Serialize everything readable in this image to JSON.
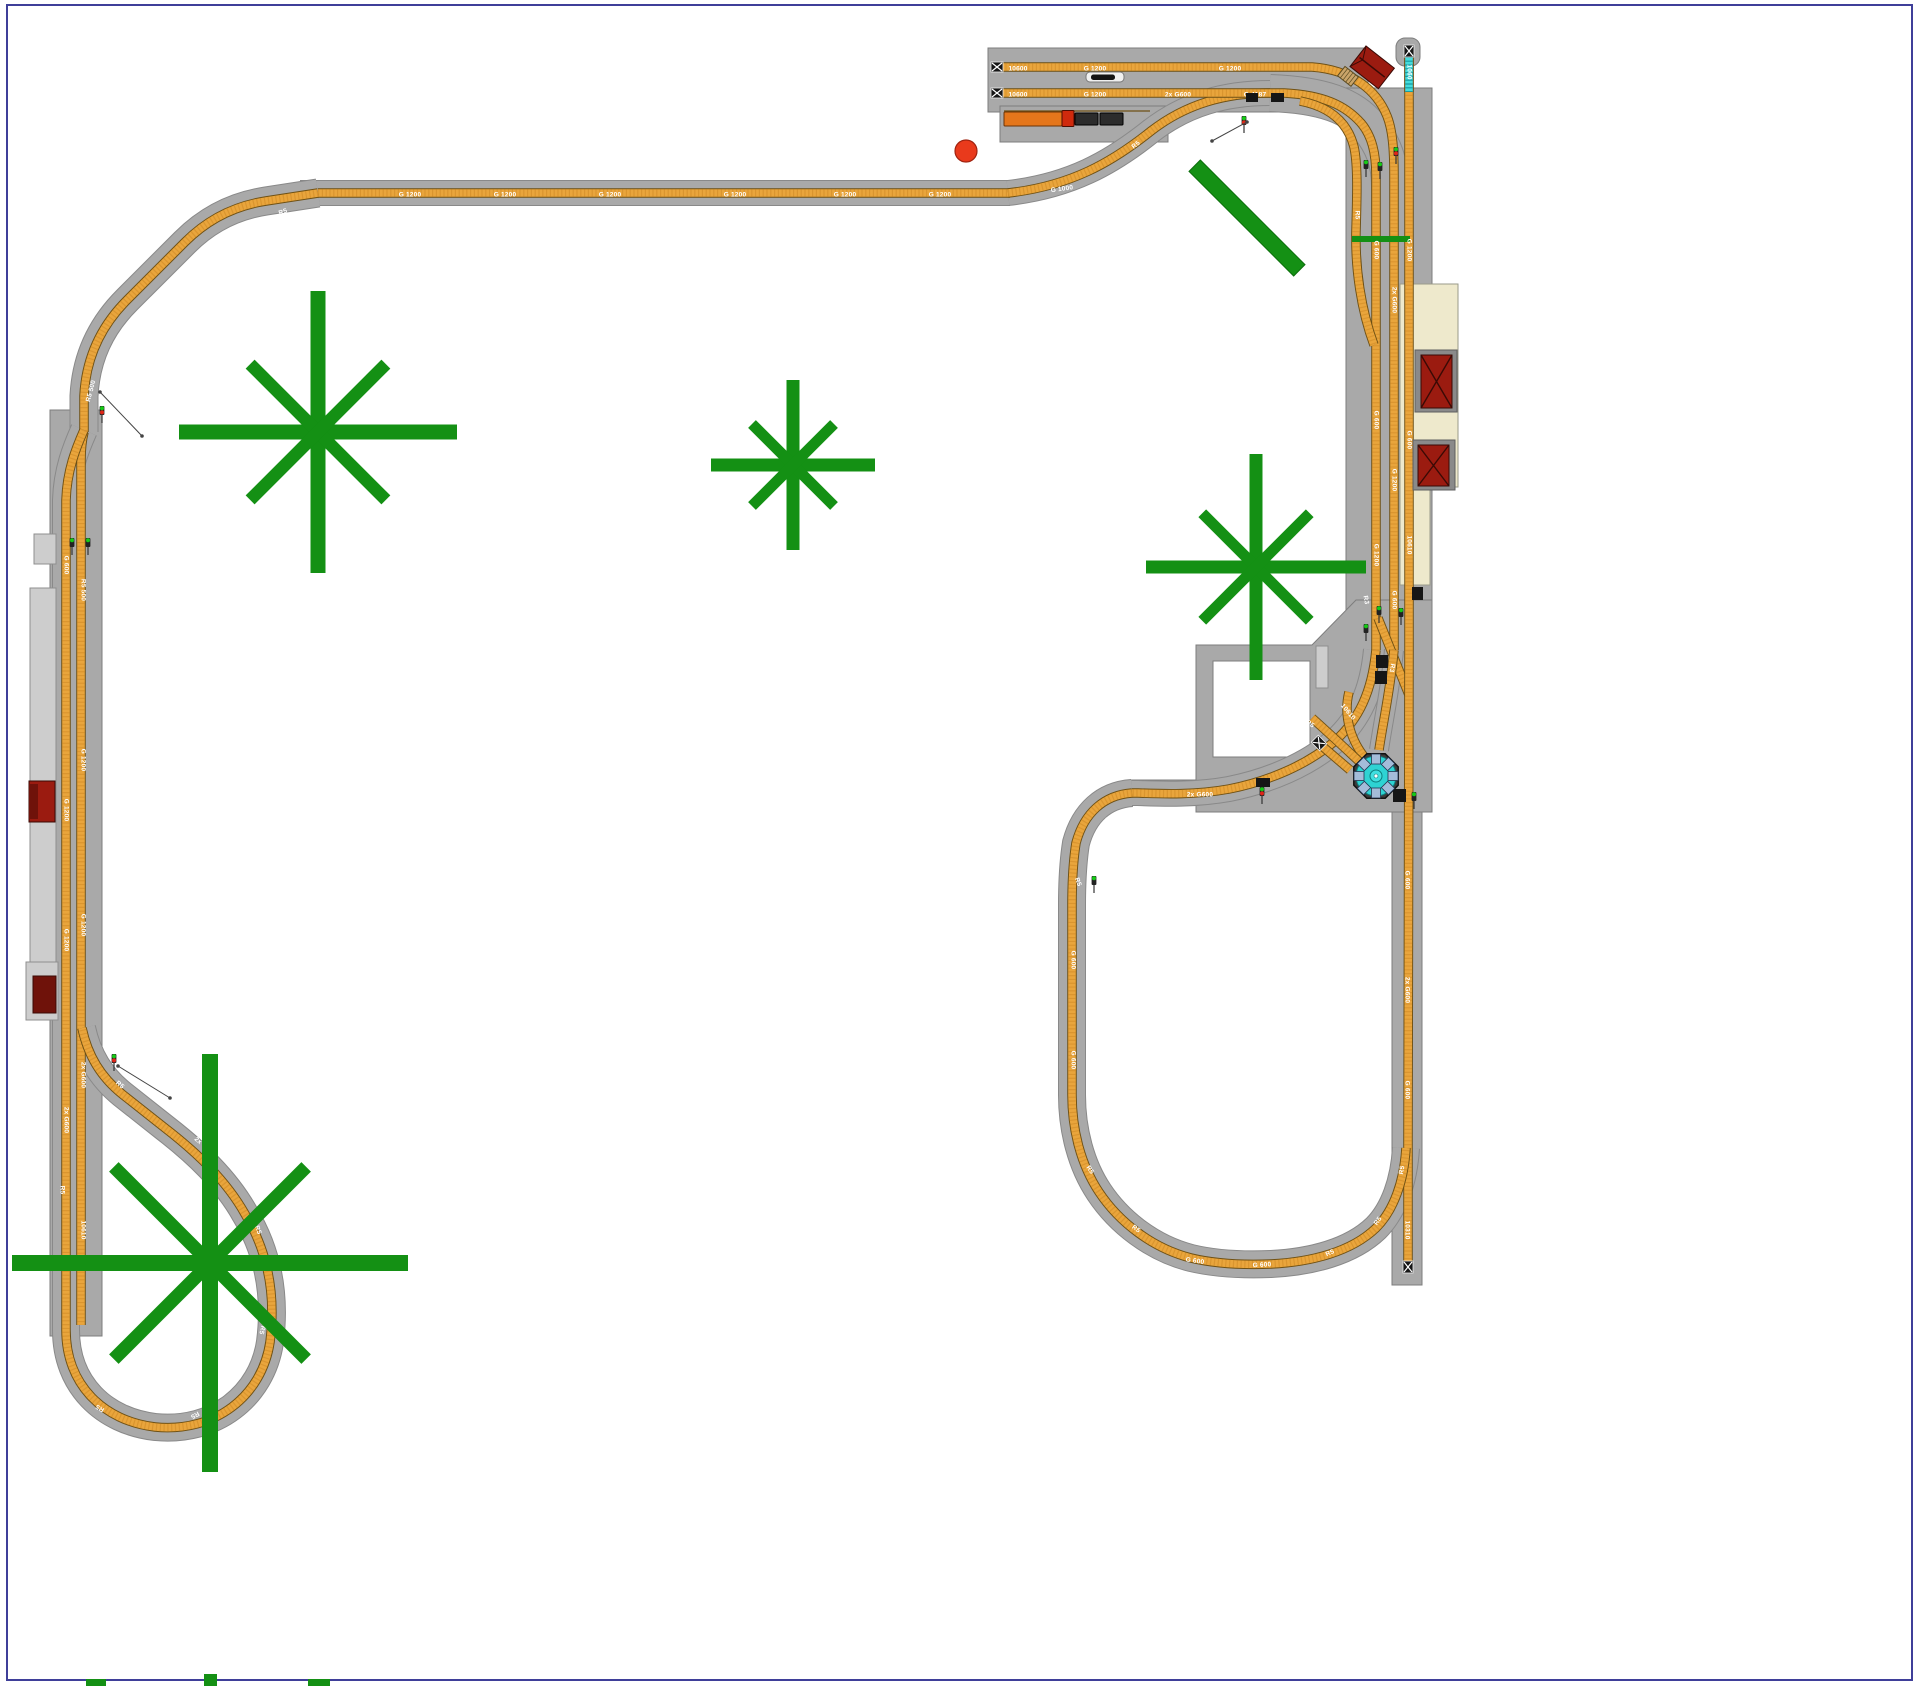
{
  "title": "G-scale model railway track plan",
  "colors": {
    "bg": "#ffffff",
    "border": "#3f3f99",
    "roadbed": "#a9a9a9",
    "roadbed_edge": "#898989",
    "gray_fill": "#a9a9a9",
    "gray_edge": "#7d7d7d",
    "platform": "#cdcdcd",
    "platform_edge": "#8f8f8f",
    "cream": "#eee9cc",
    "cream_edge": "#9a9a8a",
    "track_edge": "#6e5014",
    "track_fill": "#e9a53c",
    "track_tie": "#c8832176",
    "cyan_track": "#43dcdc",
    "building_red": "#9b1b10",
    "building_dark": "#6f120a",
    "roof_line": "#3a0a05",
    "tree": "#149014",
    "tree_edge": "#0c6e0c",
    "turntable_cyan": "#2ed3d3",
    "turntable_stub": "#a4bcd9",
    "signal_green": "#16c916",
    "signal_red": "#e02618",
    "black": "#161616",
    "dot_red": "#e93a1c",
    "dot_red_edge": "#a02310",
    "white": "#ffffff"
  },
  "grays": [
    {
      "r": [
        988,
        48,
        380,
        64
      ],
      "name": "siding-yard-base"
    },
    {
      "r": [
        1000,
        106,
        168,
        36
      ],
      "name": "siding-yard-base-lower"
    },
    {
      "r": [
        1346,
        88,
        86,
        567
      ],
      "name": "right-main-roadbed-strip"
    },
    {
      "r": [
        1130,
        780,
        70,
        24
      ],
      "name": "oval-top-roadbed-strip"
    },
    {
      "r": [
        1392,
        812,
        30,
        473
      ],
      "name": "right-siding-roadbed-strip"
    },
    {
      "r": [
        50,
        410,
        52,
        926
      ],
      "name": "left-main-roadbed-strip"
    },
    {
      "r": [
        1396,
        38,
        24,
        28,
        9
      ],
      "name": "top-right-buffer-cap"
    }
  ],
  "gray_paths": [
    {
      "d": "M1196,645 L1312,645 L1356,600 L1432,600 L1432,812 L1196,812 Z M1213,661 L1310,661 L1310,757 L1213,757 Z",
      "name": "engine-shed-footprint"
    }
  ],
  "platforms": [
    {
      "r": [
        30,
        588,
        26,
        374
      ],
      "name": "left-platform"
    },
    {
      "r": [
        34,
        534,
        22,
        30
      ],
      "name": "left-platform-tab"
    },
    {
      "r": [
        26,
        962,
        32,
        58
      ],
      "name": "left-platform-lower"
    },
    {
      "r": [
        1316,
        646,
        12,
        42
      ],
      "name": "mid-right-platform"
    }
  ],
  "cream_path": {
    "d": "M1400,284 L1458,284 L1458,487 L1430,487 L1430,585 L1400,585 Z",
    "name": "station-platform-cream"
  },
  "roadbeds": [
    {
      "d": "M300,193 L1010,193",
      "w": 24
    },
    {
      "d": "M318,193 L266,201 C233,206 207,220 185,242 L127,300 C101,326 86,357 84,396 L84,432",
      "w": 27
    },
    {
      "d": "M1008,193 C1070,186 1111,163 1151,131 C1186,104 1225,93 1270,93",
      "w": 24
    },
    {
      "d": "M1270,93 C1323,95 1352,106 1369,127 C1383,144 1390,162 1390,186 L1390,210",
      "w": 36
    },
    {
      "d": "M84,430 C76,448 67,470 66,500 L66,1330 C66,1385 104,1421 155,1427 C215,1433 262,1396 270,1342 C276,1295 268,1252 245,1214 C226,1180 196,1152 165,1128 L122,1094 C101,1077 88,1056 82,1028",
      "w": 26
    },
    {
      "d": "M1132,793 C1104,795 1084,813 1076,843 C1073,862 1072,884 1072,905 L1072,1095 C1072,1130 1081,1165 1099,1192 C1119,1222 1152,1248 1191,1258 C1216,1264 1246,1265 1271,1264 C1311,1262 1351,1252 1376,1228 C1394,1210 1404,1181 1406,1148",
      "w": 26
    },
    {
      "d": "M1376,650 C1372,692 1359,719 1335,741 C1307,765 1269,781 1229,789 C1196,795 1164,794 1138,793 L1132,793",
      "w": 24
    },
    {
      "d": "M1394,650 C1390,692 1383,722 1379,750",
      "w": 18
    }
  ],
  "tracks": [
    {
      "d": "M318,193 L1010,193",
      "name": "main-line-top-straight"
    },
    {
      "d": "M318,193 L266,201 C233,206 207,220 185,242 L127,300 C101,326 86,357 84,396 L84,432",
      "name": "main-line-top-left-diagonal"
    },
    {
      "d": "M84,432 C82,440 81,450 81,460 L81,1325",
      "name": "left-inner-track"
    },
    {
      "d": "M84,430 C76,448 67,470 66,500 L66,1330 C66,1385 104,1421 155,1427 C215,1433 262,1396 270,1342 C276,1295 268,1252 245,1214 C226,1180 196,1152 165,1128 L122,1094 C101,1077 88,1056 82,1028",
      "name": "left-outer-track-balloon-loop"
    },
    {
      "d": "M1008,193 C1070,186 1111,163 1151,131 C1186,104 1225,93 1270,93",
      "name": "main-line-yard-approach"
    },
    {
      "d": "M994,67 L1312,67 C1353,70 1377,91 1387,116 C1393,131 1394,152 1394,176 L1394,650",
      "name": "yard-siding-1"
    },
    {
      "d": "M994,93 L1284,93 C1323,95 1345,105 1361,123 C1372,136 1376,153 1376,176 L1376,650",
      "name": "yard-siding-2"
    },
    {
      "d": "M1300,101 C1331,107 1348,123 1354,147 C1358,165 1357,196 1356,230 C1355,268 1361,310 1374,345",
      "name": "yard-connector-track"
    },
    {
      "d": "M1409,53 L1409,650",
      "name": "right-stub-track"
    },
    {
      "d": "M1378,618 L1409,695",
      "name": "junction-crossover"
    },
    {
      "d": "M1376,650 C1372,692 1359,719 1335,741 C1307,765 1269,781 1229,789 C1196,795 1164,794 1138,793 L1132,793",
      "name": "junction-to-oval-curve"
    },
    {
      "d": "M1394,650 C1390,692 1383,722 1379,750",
      "name": "junction-to-turntable"
    },
    {
      "d": "M1409,650 L1408,1140 L1408,1262",
      "name": "right-long-siding"
    },
    {
      "d": "M1132,793 C1104,795 1084,813 1076,843 C1073,862 1072,884 1072,905 L1072,1095 C1072,1130 1081,1165 1099,1192 C1119,1222 1152,1248 1191,1258 C1216,1264 1246,1265 1271,1264 C1311,1262 1351,1252 1376,1228 C1394,1210 1404,1181 1406,1148",
      "name": "lower-oval-track"
    },
    {
      "d": "M1349,692 C1343,716 1351,741 1366,759",
      "name": "turntable-approach-1"
    },
    {
      "d": "M1312,718 C1331,735 1349,752 1363,765",
      "name": "turntable-approach-2"
    },
    {
      "d": "M1322,746 L1350,770",
      "name": "turntable-stub-siding"
    }
  ],
  "cyan_tracks": [
    {
      "d": "M1409,53 L1409,92",
      "name": "selected-track-piece"
    }
  ],
  "misc_rects": [
    {
      "r": [
        1352,
        236,
        58,
        6
      ],
      "f": "tree",
      "name": "track-contact-strip"
    }
  ],
  "misc_lines": [
    {
      "p": [
        1004,
        111,
        1150,
        111
      ],
      "s": "#6e5014",
      "w": 1.2,
      "name": "platform-edge-rail"
    }
  ],
  "labels": [
    {
      "t": "10600",
      "x": 1018,
      "y": 69,
      "r": 0
    },
    {
      "t": "G 1200",
      "x": 1095,
      "y": 69,
      "r": 0
    },
    {
      "t": "G 1200",
      "x": 1230,
      "y": 69,
      "r": 0
    },
    {
      "t": "10600",
      "x": 1018,
      "y": 95,
      "r": 0
    },
    {
      "t": "G 1200",
      "x": 1095,
      "y": 95,
      "r": 0
    },
    {
      "t": "2x G600",
      "x": 1178,
      "y": 95,
      "r": 0
    },
    {
      "t": "G 4187",
      "x": 1255,
      "y": 95,
      "r": 0
    },
    {
      "t": "G 1200",
      "x": 410,
      "y": 195,
      "r": 0
    },
    {
      "t": "G 1200",
      "x": 505,
      "y": 195,
      "r": 0
    },
    {
      "t": "G 1200",
      "x": 610,
      "y": 195,
      "r": 0
    },
    {
      "t": "G 1200",
      "x": 735,
      "y": 195,
      "r": 0
    },
    {
      "t": "G 1200",
      "x": 845,
      "y": 195,
      "r": 0
    },
    {
      "t": "G 1200",
      "x": 940,
      "y": 195,
      "r": 0
    },
    {
      "t": "G 1000",
      "x": 1062,
      "y": 189,
      "r": -8
    },
    {
      "t": "R5",
      "x": 1136,
      "y": 145,
      "r": -38
    },
    {
      "t": "R5",
      "x": 283,
      "y": 212,
      "r": -20
    },
    {
      "t": "G 1200",
      "x": 196,
      "y": 261,
      "r": -44
    },
    {
      "t": "G 600",
      "x": 133,
      "y": 323,
      "r": -48
    },
    {
      "t": "R5 500",
      "x": 91,
      "y": 391,
      "r": -75
    },
    {
      "t": "G 600",
      "x": 66,
      "y": 565,
      "r": 90
    },
    {
      "t": "G 1200",
      "x": 66,
      "y": 810,
      "r": 90
    },
    {
      "t": "G 1200",
      "x": 66,
      "y": 940,
      "r": 90
    },
    {
      "t": "2x G600",
      "x": 66,
      "y": 1120,
      "r": 90
    },
    {
      "t": "R5 500",
      "x": 83,
      "y": 590,
      "r": 90
    },
    {
      "t": "G 1200",
      "x": 83,
      "y": 760,
      "r": 90
    },
    {
      "t": "G 1200",
      "x": 83,
      "y": 925,
      "r": 90
    },
    {
      "t": "2x G600",
      "x": 83,
      "y": 1075,
      "r": 90
    },
    {
      "t": "10610",
      "x": 83,
      "y": 1230,
      "r": 90
    },
    {
      "t": "R5",
      "x": 120,
      "y": 1085,
      "r": 40
    },
    {
      "t": "2x G600",
      "x": 205,
      "y": 1147,
      "r": 42
    },
    {
      "t": "R5",
      "x": 258,
      "y": 1230,
      "r": 70
    },
    {
      "t": "R5",
      "x": 262,
      "y": 1330,
      "r": 105
    },
    {
      "t": "R5",
      "x": 195,
      "y": 1415,
      "r": 150
    },
    {
      "t": "R5",
      "x": 100,
      "y": 1408,
      "r": -150
    },
    {
      "t": "R5",
      "x": 62,
      "y": 1190,
      "r": 90
    },
    {
      "t": "R5",
      "x": 1357,
      "y": 215,
      "r": 90
    },
    {
      "t": "G 600",
      "x": 1376,
      "y": 250,
      "r": 90
    },
    {
      "t": "G 600",
      "x": 1376,
      "y": 420,
      "r": 90
    },
    {
      "t": "G 1200",
      "x": 1376,
      "y": 555,
      "r": 90
    },
    {
      "t": "2x G600",
      "x": 1394,
      "y": 300,
      "r": 90
    },
    {
      "t": "G 1200",
      "x": 1394,
      "y": 480,
      "r": 90
    },
    {
      "t": "G 600",
      "x": 1394,
      "y": 600,
      "r": 90
    },
    {
      "t": "1060",
      "x": 1409,
      "y": 72,
      "r": 90
    },
    {
      "t": "G 1200",
      "x": 1409,
      "y": 250,
      "r": 90
    },
    {
      "t": "G 600",
      "x": 1409,
      "y": 440,
      "r": 90
    },
    {
      "t": "10610",
      "x": 1409,
      "y": 545,
      "r": 90
    },
    {
      "t": "R3",
      "x": 1366,
      "y": 600,
      "r": 80
    },
    {
      "t": "R3",
      "x": 1392,
      "y": 668,
      "r": 100
    },
    {
      "t": "10610",
      "x": 1348,
      "y": 712,
      "r": 50
    },
    {
      "t": "R5",
      "x": 1310,
      "y": 724,
      "r": 35
    },
    {
      "t": "G 600",
      "x": 1407,
      "y": 880,
      "r": 90
    },
    {
      "t": "2x G600",
      "x": 1407,
      "y": 990,
      "r": 90
    },
    {
      "t": "G 600",
      "x": 1407,
      "y": 1090,
      "r": 90
    },
    {
      "t": "10310",
      "x": 1407,
      "y": 1230,
      "r": 90
    },
    {
      "t": "2x G600",
      "x": 1200,
      "y": 795,
      "r": 0
    },
    {
      "t": "R5",
      "x": 1108,
      "y": 822,
      "r": 30
    },
    {
      "t": "R5",
      "x": 1078,
      "y": 882,
      "r": 70
    },
    {
      "t": "G 600",
      "x": 1073,
      "y": 960,
      "r": 90
    },
    {
      "t": "G 600",
      "x": 1073,
      "y": 1060,
      "r": 90
    },
    {
      "t": "R5",
      "x": 1090,
      "y": 1170,
      "r": 55
    },
    {
      "t": "R5",
      "x": 1136,
      "y": 1229,
      "r": 35
    },
    {
      "t": "G 600",
      "x": 1195,
      "y": 1261,
      "r": 8
    },
    {
      "t": "G 600",
      "x": 1262,
      "y": 1265,
      "r": -3
    },
    {
      "t": "R5",
      "x": 1330,
      "y": 1253,
      "r": -25
    },
    {
      "t": "R5",
      "x": 1378,
      "y": 1221,
      "r": -55
    },
    {
      "t": "R5",
      "x": 1402,
      "y": 1170,
      "r": -80
    }
  ],
  "blacks": [
    {
      "r": [
        1246,
        93,
        12,
        9
      ]
    },
    {
      "r": [
        1271,
        93,
        13,
        9
      ]
    },
    {
      "r": [
        1412,
        587,
        11,
        13
      ]
    },
    {
      "r": [
        1376,
        655,
        12,
        13
      ]
    },
    {
      "r": [
        1375,
        671,
        12,
        13
      ]
    },
    {
      "r": [
        1393,
        789,
        13,
        13
      ]
    },
    {
      "r": [
        1256,
        778,
        14,
        9
      ]
    }
  ],
  "bumpers": [
    {
      "x": 997,
      "y": 67,
      "rot": -90
    },
    {
      "x": 997,
      "y": 93,
      "rot": -90
    },
    {
      "x": 1409,
      "y": 51,
      "rot": 0
    },
    {
      "x": 1408,
      "y": 1267,
      "rot": 180
    },
    {
      "x": 1319,
      "y": 743,
      "rot": -45
    }
  ],
  "signals": [
    {
      "x": 1366,
      "y": 168,
      "c": "g"
    },
    {
      "x": 1380,
      "y": 170,
      "c": "g"
    },
    {
      "x": 1396,
      "y": 155,
      "c": "rg"
    },
    {
      "x": 1244,
      "y": 124,
      "c": "rg"
    },
    {
      "x": 102,
      "y": 414,
      "c": "rg"
    },
    {
      "x": 72,
      "y": 546,
      "c": "g"
    },
    {
      "x": 88,
      "y": 546,
      "c": "g"
    },
    {
      "x": 114,
      "y": 1062,
      "c": "rg"
    },
    {
      "x": 1094,
      "y": 884,
      "c": "g"
    },
    {
      "x": 1262,
      "y": 795,
      "c": "rg"
    },
    {
      "x": 1379,
      "y": 614,
      "c": "g"
    },
    {
      "x": 1401,
      "y": 616,
      "c": "g"
    },
    {
      "x": 1366,
      "y": 632,
      "c": "g"
    },
    {
      "x": 1414,
      "y": 800,
      "c": "g"
    }
  ],
  "measure_lines": [
    {
      "p": [
        1212,
        141,
        1247,
        122
      ]
    },
    {
      "p": [
        118,
        1066,
        170,
        1098
      ]
    },
    {
      "p": [
        100,
        392,
        142,
        436
      ]
    }
  ],
  "buildings": {
    "rotated_red": {
      "x": 1366,
      "y": 46,
      "w": 36,
      "h": 26,
      "rot": 38,
      "steps": {
        "dx": -4,
        "dy": 29,
        "w": 17,
        "h": 12
      }
    },
    "left_shed_1": {
      "x": 29,
      "y": 781,
      "w": 26,
      "h": 41,
      "darkw": 9
    },
    "left_shed_2": {
      "x": 33,
      "y": 976,
      "w": 23,
      "h": 37
    },
    "xroof": [
      {
        "bx": 1415,
        "by": 350,
        "bw": 42,
        "bh": 62,
        "x": 1421,
        "y": 355,
        "w": 31,
        "h": 53
      },
      {
        "bx": 1413,
        "by": 440,
        "bw": 42,
        "bh": 50,
        "x": 1418,
        "y": 445,
        "w": 31,
        "h": 41
      }
    ]
  },
  "turntable": {
    "cx": 1376,
    "cy": 776,
    "radius": 24,
    "stubs": 8
  },
  "trains": [
    {
      "name": "white-locomotive",
      "parts": [
        {
          "r": [
            1086,
            72,
            38,
            10,
            4
          ],
          "f": "#f0f0f0",
          "s": "#777777"
        },
        {
          "r": [
            1091,
            74.5,
            24,
            5.5,
            2.5
          ],
          "f": "#141414",
          "s": "none"
        }
      ]
    },
    {
      "name": "orange-train",
      "parts": [
        {
          "r": [
            1004,
            112,
            58,
            14,
            1
          ],
          "f": "#e4761b",
          "s": "#6b3407"
        },
        {
          "r": [
            1062,
            110.5,
            12,
            16,
            1
          ],
          "f": "#cf2a0d",
          "s": "#4e0d02"
        },
        {
          "r": [
            1075,
            113,
            23,
            12,
            1
          ],
          "f": "#2c2c2c",
          "s": "#000000"
        },
        {
          "r": [
            1100,
            113,
            23,
            12,
            1
          ],
          "f": "#2c2c2c",
          "s": "#000000"
        }
      ]
    }
  ],
  "trees": [
    {
      "cx": 318,
      "cy": 432,
      "hx": 139,
      "vy": 141,
      "diag": 96,
      "w": 15
    },
    {
      "cx": 793,
      "cy": 465,
      "hx": 82,
      "vy": 85,
      "diag": 58,
      "w": 13
    },
    {
      "cx": 1256,
      "cy": 567,
      "hx": 110,
      "vy": 113,
      "diag": 76,
      "w": 13
    },
    {
      "cx": 210,
      "cy": 1263,
      "hx": 198,
      "vy": 209,
      "diag": 136,
      "w": 16
    }
  ],
  "green_bar": {
    "cx": 1247,
    "cy": 218,
    "len": 148,
    "w": 16,
    "rot": 45
  },
  "red_dot": {
    "cx": 966,
    "cy": 151,
    "r": 11
  },
  "bottom_nubs": [
    [
      86,
      1679,
      20,
      7
    ],
    [
      204,
      1674,
      13,
      12
    ],
    [
      308,
      1679,
      22,
      7
    ]
  ],
  "border": {
    "x": 7,
    "y": 5,
    "w": 1905,
    "h": 1675
  }
}
